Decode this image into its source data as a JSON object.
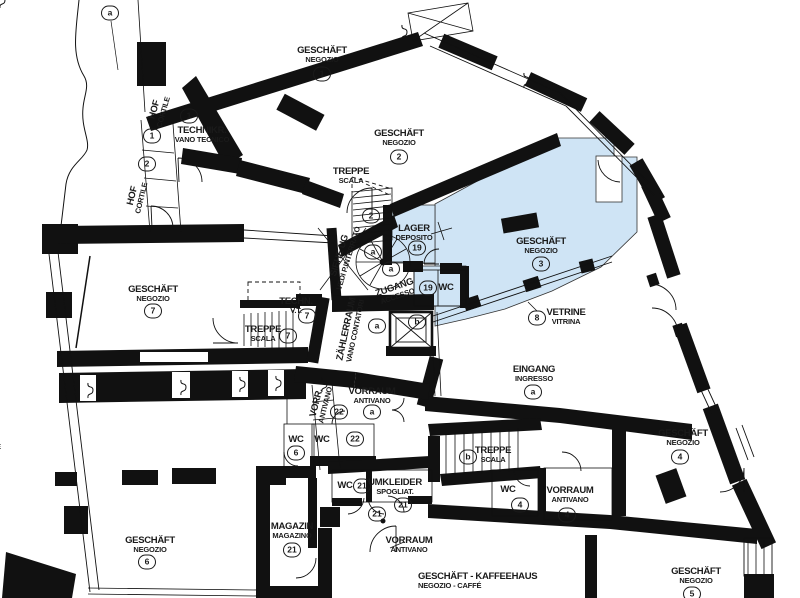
{
  "plan": {
    "type": "architectural-floor-plan",
    "languages": [
      "DE",
      "IT"
    ],
    "highlight_color": "#cfe4f5",
    "wall_color": "#111111",
    "highlighted_unit": "GESCHÄFT / NEGOZIO 3 (with LAGER/DEPOSITO 19, ZUGANG/ACCESSO, WC 19)",
    "rooms": [
      {
        "name": "geschaeft-1",
        "de": "GESCHÄFT",
        "it": "NEGOZIO",
        "x": 322,
        "y": 55,
        "badge": "1",
        "bdx": 0,
        "bdy": 19
      },
      {
        "name": "geschaeft-2",
        "de": "GESCHÄFT",
        "it": "NEGOZIO",
        "x": 399,
        "y": 138,
        "badge": "2",
        "bdx": 0,
        "bdy": 19
      },
      {
        "name": "geschaeft-3",
        "de": "GESCHÄFT",
        "it": "NEGOZIO",
        "x": 541,
        "y": 246,
        "badge": "3",
        "bdx": 0,
        "bdy": 18
      },
      {
        "name": "geschaeft-4",
        "de": "GESCHÄFT",
        "it": "NEGOZIO",
        "x": 683,
        "y": 438,
        "badge": "4",
        "bdx": -3,
        "bdy": 19
      },
      {
        "name": "geschaeft-5",
        "de": "GESCHÄFT",
        "it": "NEGOZIO",
        "x": 696,
        "y": 576,
        "badge": "5",
        "bdx": -4,
        "bdy": 18
      },
      {
        "name": "geschaeft-6",
        "de": "GESCHÄFT",
        "it": "NEGOZIO",
        "x": 150,
        "y": 545,
        "badge": "6",
        "bdx": -3,
        "bdy": 17
      },
      {
        "name": "geschaeft-7",
        "de": "GESCHÄFT",
        "it": "NEGOZIO",
        "x": 153,
        "y": 294,
        "badge": "7",
        "bdx": 0,
        "bdy": 17
      },
      {
        "name": "kaffeehaus",
        "de": "GESCHÄFT - KAFFEEHAUS",
        "it": "NEGOZIO - CAFFÉ",
        "x": 418,
        "y": 581,
        "align": "left"
      },
      {
        "name": "technikraum",
        "de": "TECHNIKR.",
        "it": "VANO TECNICO",
        "x": 202,
        "y": 135,
        "badge": "1",
        "bdx": -13,
        "bdy": -19
      },
      {
        "name": "hof-1",
        "de": "HOF",
        "it": "CORTILE",
        "x": 159,
        "y": 111,
        "rot": -74
      },
      {
        "name": "hof-2",
        "de": "HOF",
        "it": "CORTILE",
        "x": 137,
        "y": 197,
        "rot": -76
      },
      {
        "name": "hof-cut",
        "de": "HOF",
        "it": "CORTILE",
        "x": -15,
        "y": 442,
        "badge": "",
        "bdx": 3,
        "bdy": 20
      },
      {
        "name": "treppe-og",
        "de": "TREPPE",
        "it": "SCALA",
        "x": 351,
        "y": 176
      },
      {
        "name": "lager",
        "de": "LAGER",
        "it": "DEPOSITO",
        "x": 414,
        "y": 233,
        "badge": "19",
        "bdx": 3,
        "bdy": 15
      },
      {
        "name": "siehe-ug",
        "de": "SIEHE UG",
        "it": "VEDI P.INTERRATO",
        "x": 344,
        "y": 257,
        "rot": -73
      },
      {
        "name": "zugang",
        "de": "ZUGANG",
        "it": "ACCESSO",
        "x": 396,
        "y": 292,
        "rot": -19
      },
      {
        "name": "wc-19",
        "de": "WC",
        "x": 446,
        "y": 288
      },
      {
        "name": "zaehlerraum",
        "de": "ZÄHLERRAUM",
        "it": "VANO CONTATORI",
        "x": 351,
        "y": 330,
        "rot": -78
      },
      {
        "name": "vetrine",
        "de": "VETRINE",
        "it": "VITRINA",
        "x": 566,
        "y": 317,
        "badge": "8",
        "bdx": -29,
        "bdy": 1
      },
      {
        "name": "eingang",
        "de": "EINGANG",
        "it": "INGRESSO",
        "x": 534,
        "y": 374,
        "badge": "a",
        "bdx": -1,
        "bdy": 18
      },
      {
        "name": "techn-7",
        "de": "TECHN.",
        "it": "V.T.",
        "x": 296,
        "y": 306,
        "badge": "7",
        "bdx": 11,
        "bdy": 10
      },
      {
        "name": "treppe-7",
        "de": "TREPPE",
        "it": "SCALA",
        "x": 263,
        "y": 334,
        "badge": "7",
        "bdx": 25,
        "bdy": 2
      },
      {
        "name": "vorr-22",
        "de": "VORR.",
        "it": "ANTIVANO",
        "x": 321,
        "y": 404,
        "rot": -76,
        "badge": "22",
        "bdx": 18,
        "bdy": 8
      },
      {
        "name": "vorraum-a",
        "de": "VORRAUM",
        "it": "ANTIVANO",
        "x": 372,
        "y": 396,
        "badge": "a",
        "bdx": 0,
        "bdy": 16
      },
      {
        "name": "wc-6",
        "de": "WC",
        "x": 296,
        "y": 440,
        "badge": "6",
        "bdx": 0,
        "bdy": 13
      },
      {
        "name": "wc-22",
        "de": "WC",
        "x": 322,
        "y": 440,
        "badge": "22",
        "bdx": 33,
        "bdy": -1
      },
      {
        "name": "treppe-b",
        "de": "TREPPE",
        "it": "SCALA",
        "x": 493,
        "y": 455
      },
      {
        "name": "wc-4",
        "de": "WC",
        "x": 508,
        "y": 490,
        "badge": "4",
        "bdx": 12,
        "bdy": 15
      },
      {
        "name": "vorraum-4",
        "de": "VORRAUM",
        "it": "ANTIVANO",
        "x": 570,
        "y": 495,
        "badge": "4",
        "bdx": -3,
        "bdy": 20
      },
      {
        "name": "wc-21",
        "de": "WC",
        "x": 345,
        "y": 486,
        "badge": "21",
        "bdx": 17,
        "bdy": 0
      },
      {
        "name": "umkleider",
        "de": "UMKLEIDER",
        "it": "SPOGLIAT.",
        "x": 395,
        "y": 487,
        "badge": "21",
        "bdx": 8,
        "bdy": 18
      },
      {
        "name": "vorraum-21",
        "de": "VORRAUM",
        "it": "ANTIVANO",
        "x": 409,
        "y": 545
      },
      {
        "name": "magazin",
        "de": "MAGAZIN",
        "it": "MAGAZINO",
        "x": 292,
        "y": 531,
        "badge": "21",
        "bdx": 0,
        "bdy": 19
      }
    ],
    "badges": [
      {
        "name": "axis-a",
        "t": "a",
        "x": 110,
        "y": 13
      },
      {
        "name": "hof-1-num",
        "t": "1",
        "x": 152,
        "y": 136
      },
      {
        "name": "hof-2-num",
        "t": "2",
        "x": 147,
        "y": 164
      },
      {
        "name": "treppe-og-num",
        "t": "2",
        "x": 371,
        "y": 216
      },
      {
        "name": "spiral-a-1",
        "t": "a",
        "x": 373,
        "y": 252
      },
      {
        "name": "spiral-a-2",
        "t": "a",
        "x": 391,
        "y": 269
      },
      {
        "name": "wc19-num",
        "t": "19",
        "x": 428,
        "y": 288
      },
      {
        "name": "zaehlerraum-a",
        "t": "a",
        "x": 377,
        "y": 326
      },
      {
        "name": "lift-b",
        "t": "b",
        "x": 417,
        "y": 322
      },
      {
        "name": "treppe-b-num",
        "t": "b",
        "x": 468,
        "y": 457
      },
      {
        "name": "mid-21",
        "t": "21",
        "x": 377,
        "y": 514
      }
    ]
  }
}
